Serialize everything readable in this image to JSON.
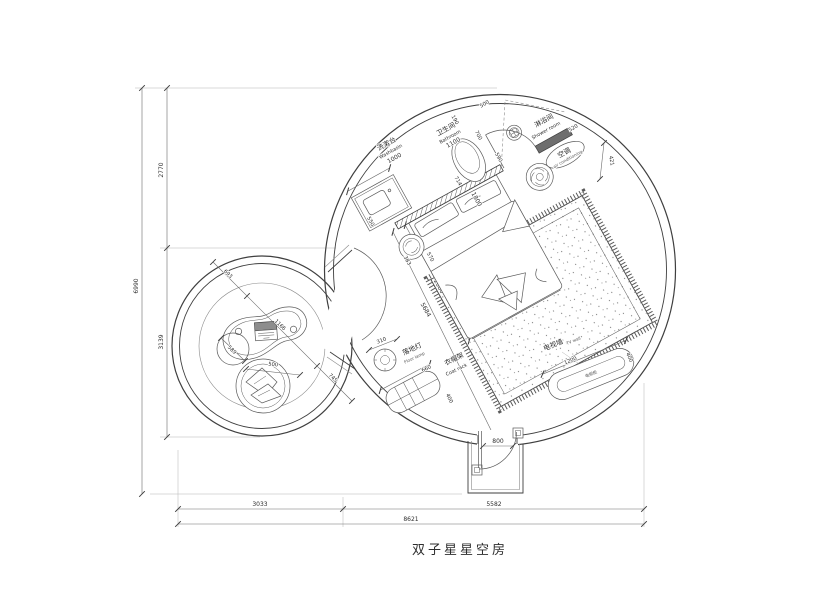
{
  "title": "双子星星空房",
  "labels": {
    "washbasin_cn": "洗漱台",
    "washbasin_en": "Washbasin",
    "bathroom_cn": "卫生间",
    "bathroom_en": "Bathroom",
    "shower_cn": "淋浴间",
    "shower_en": "Shower room",
    "ac_cn": "空调",
    "ac_en": "air conditioning",
    "floor_lamp_cn": "落地灯",
    "floor_lamp_en": "Floor lamp",
    "coat_rack_cn": "衣帽架",
    "coat_rack_en": "Coat rack",
    "tv_wall_cn": "电视墙",
    "tv_wall_en": "TV wall",
    "tv_cabinet_cn": "电视柜"
  },
  "dims": {
    "washbasin": "1000",
    "bathroom": "1100",
    "basin_side": "550",
    "bath_gap": "190",
    "bath_door": "700",
    "shower_opening": "500",
    "shower_screen": "520",
    "ac_clearance": "421",
    "wall_seg": "590",
    "toilet": "714",
    "bed_width": "1800",
    "bed_length": "2000",
    "stool_a": "383",
    "stool_b": "570",
    "room_diagonal": "5684",
    "floor_lamp": "310",
    "coat_rack_w": "660",
    "coat_rack_d": "400",
    "tv_cabinet_w": "1200",
    "tv_cabinet_d": "400",
    "entry_door": "800",
    "desk_offset": "693",
    "desk_length": "1166",
    "desk_clearance": "745",
    "pouf": "589",
    "ottoman": "500",
    "height_total": "6990",
    "height_top": "2770",
    "height_bottom": "3139",
    "width_left": "3033",
    "width_right": "5582",
    "width_total": "8621"
  }
}
